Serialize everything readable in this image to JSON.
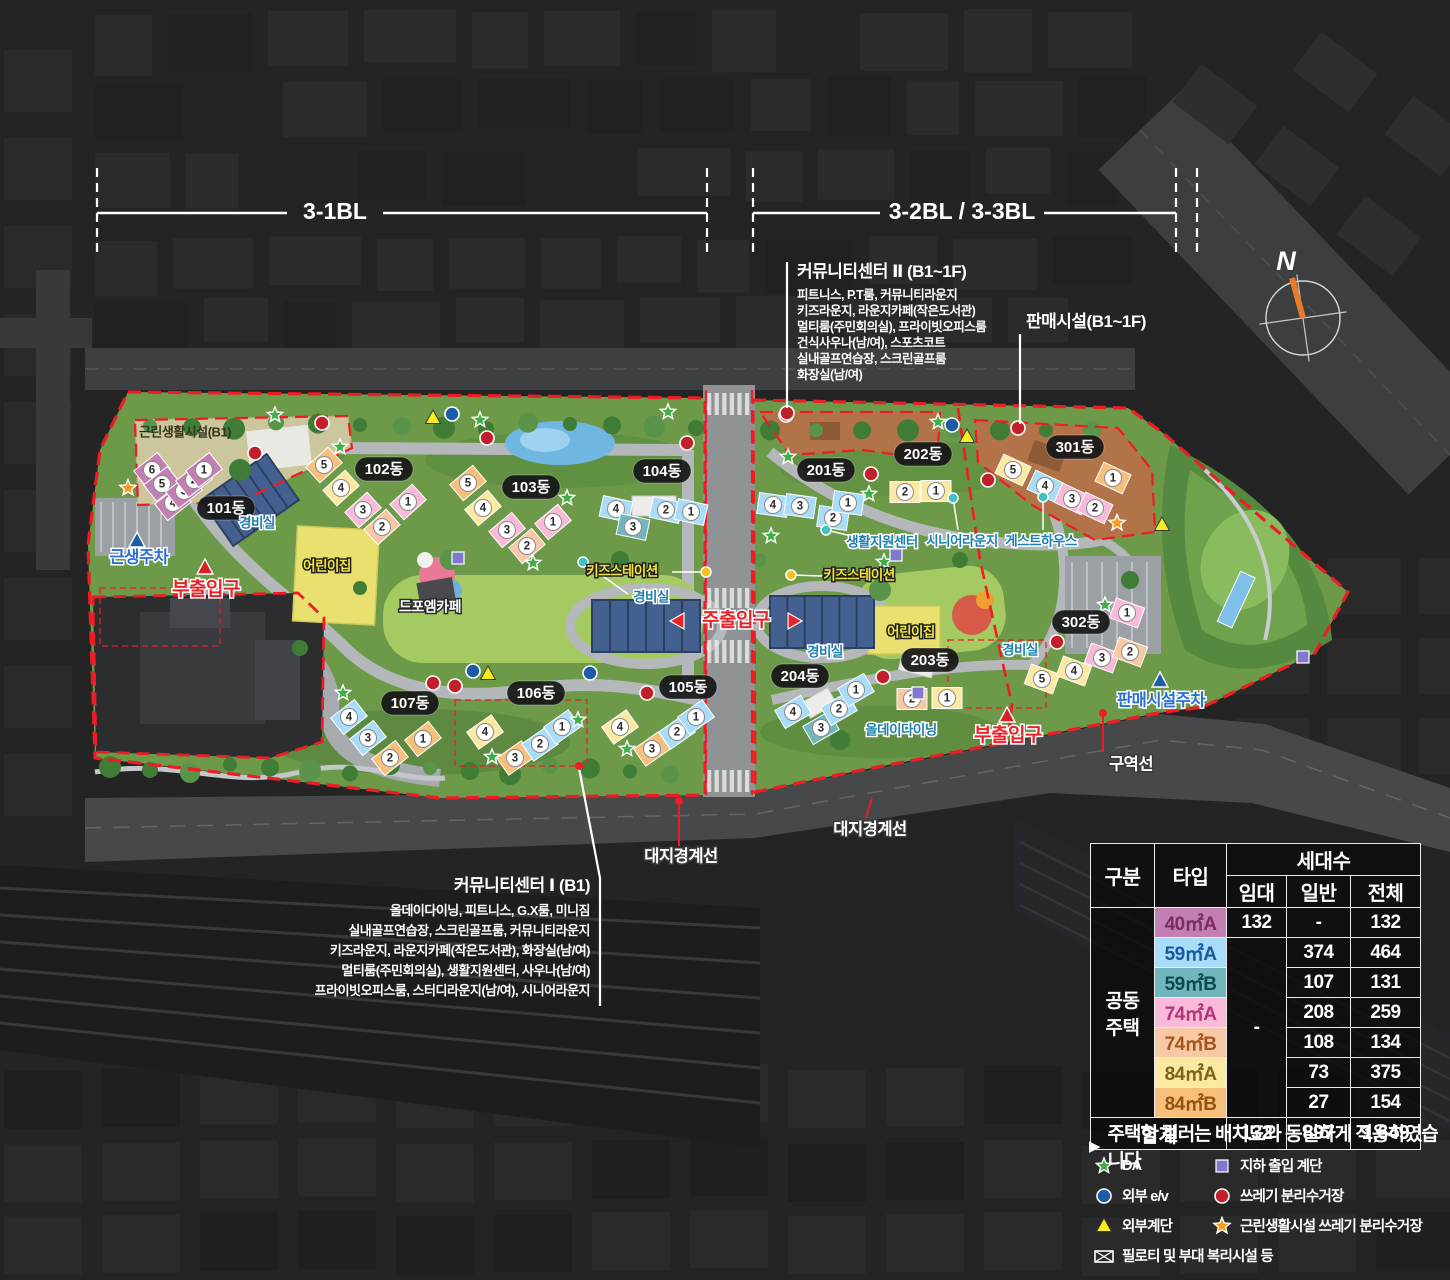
{
  "sections": [
    {
      "label": "3-1BL",
      "x1": 97,
      "x2": 707,
      "label_x": 335,
      "gap": 48,
      "y": 213
    },
    {
      "label": "3-2BL / 3-3BL",
      "x1": 753,
      "x2": 1176,
      "label_x": 962,
      "gap": 82,
      "y": 213,
      "extra_dash_x": 1197
    }
  ],
  "compass": {
    "label": "N"
  },
  "annotations": {
    "community2": {
      "title": "커뮤니티센터 Ⅱ (B1~1F)",
      "lines": [
        "피트니스, P.T룸, 커뮤니티라운지",
        "키즈라운지, 라운지카페(작은도서관)",
        "멀티룸(주민회의실), 프라이빗오피스룸",
        "건식사우나(남/여), 스포츠코트",
        "실내골프연습장, 스크린골프룸",
        "화장실(남/여)"
      ]
    },
    "sales": {
      "title": "판매시설(B1~1F)"
    },
    "community1": {
      "title": "커뮤니티센터 Ⅰ (B1)",
      "lines": [
        "올데이다이닝, 피트니스, G.X룸, 미니짐",
        "실내골프연습장, 스크린골프룸, 커뮤니티라운지",
        "키즈라운지, 라운지카페(작은도서관), 화장실(남/여)",
        "멀티룸(주민회의실), 생활지원센터, 사우나(남/여)",
        "프라이빗오피스룸, 스터디라운지(남/여), 시니어라운지"
      ]
    }
  },
  "table": {
    "col_category": "구분",
    "col_type": "타입",
    "col_units": "세대수",
    "sub_cols": [
      "임대",
      "일반",
      "전체"
    ],
    "group": "공동\n주택",
    "rent_merged": "-",
    "rows": [
      {
        "type": "40㎡A",
        "color": "#c27fb3",
        "text_color": "#7c2a60",
        "rent": "132",
        "general": "-",
        "total": "132"
      },
      {
        "type": "59㎡A",
        "color": "#a9dcf8",
        "text_color": "#15599c",
        "general": "374",
        "total": "464"
      },
      {
        "type": "59㎡B",
        "color": "#72b6bd",
        "text_color": "#0c4950",
        "general": "107",
        "total": "131"
      },
      {
        "type": "74㎡A",
        "color": "#f9bada",
        "text_color": "#b13577",
        "general": "208",
        "total": "259"
      },
      {
        "type": "74㎡B",
        "color": "#f7c8a4",
        "text_color": "#a4561e",
        "general": "108",
        "total": "134"
      },
      {
        "type": "84㎡A",
        "color": "#fbe9a2",
        "text_color": "#7c621a",
        "general": "73",
        "total": "375"
      },
      {
        "type": "84㎡B",
        "color": "#f6c07c",
        "text_color": "#97510f",
        "general": "27",
        "total": "154"
      }
    ],
    "total_row": {
      "label": "합계",
      "rent": "132",
      "general": "897",
      "total": "1,649"
    }
  },
  "note": {
    "marker": "▶",
    "text": "주택형 컬러는 배치도와 동일하게 적용하였습니다"
  },
  "legend": {
    "items": [
      {
        "icon": "star_green",
        "label": "DA"
      },
      {
        "icon": "square_purple",
        "label": "지하 출입 계단"
      },
      {
        "icon": "circle_blue",
        "label": "외부 e/v"
      },
      {
        "icon": "circle_red",
        "label": "쓰레기 분리수거장"
      },
      {
        "icon": "triangle_yellow",
        "label": "외부계단"
      },
      {
        "icon": "star_orange",
        "label": "근린생활시설 쓰레기 분리수거장"
      },
      {
        "icon": "box_x",
        "label": "필로티 및 부대 복리시설 등"
      }
    ]
  },
  "map": {
    "type_colors": {
      "40A": "#c27fb3",
      "59A": "#a9dcf8",
      "59B": "#72b6bd",
      "74A": "#f9bada",
      "74B": "#f7c8a4",
      "84A": "#fbe9a2",
      "84B": "#f6c07c"
    },
    "pills": [
      {
        "text": "101동",
        "x": 226,
        "y": 508
      },
      {
        "text": "102동",
        "x": 384,
        "y": 469
      },
      {
        "text": "103동",
        "x": 531,
        "y": 487
      },
      {
        "text": "104동",
        "x": 662,
        "y": 471
      },
      {
        "text": "105동",
        "x": 688,
        "y": 687
      },
      {
        "text": "106동",
        "x": 536,
        "y": 693
      },
      {
        "text": "107동",
        "x": 410,
        "y": 703
      },
      {
        "text": "201동",
        "x": 826,
        "y": 470
      },
      {
        "text": "202동",
        "x": 923,
        "y": 454
      },
      {
        "text": "203동",
        "x": 930,
        "y": 660
      },
      {
        "text": "204동",
        "x": 800,
        "y": 676
      },
      {
        "text": "301동",
        "x": 1075,
        "y": 447
      },
      {
        "text": "302동",
        "x": 1081,
        "y": 622
      }
    ],
    "buildings": [
      {
        "name": "101동",
        "rot": -38,
        "units": [
          [
            152,
            470,
            6,
            "40A"
          ],
          [
            162,
            484,
            5,
            "40A"
          ],
          [
            173,
            503,
            4,
            "40A"
          ],
          [
            184,
            491,
            3,
            "40A"
          ],
          [
            194,
            480,
            2,
            "40A"
          ],
          [
            204,
            470,
            1,
            "40A"
          ]
        ]
      },
      {
        "name": "102동",
        "rot": -42,
        "units": [
          [
            324,
            465,
            5,
            "84B"
          ],
          [
            341,
            488,
            4,
            "84A"
          ],
          [
            363,
            510,
            3,
            "74A"
          ],
          [
            382,
            527,
            2,
            "74B"
          ],
          [
            408,
            502,
            1,
            "74A"
          ]
        ]
      },
      {
        "name": "103동",
        "rot": -40,
        "units": [
          [
            468,
            483,
            5,
            "84B"
          ],
          [
            483,
            508,
            4,
            "84A"
          ],
          [
            507,
            530,
            3,
            "74A"
          ],
          [
            527,
            546,
            2,
            "74B"
          ],
          [
            553,
            522,
            1,
            "74A"
          ]
        ]
      },
      {
        "name": "104동",
        "rot": 12,
        "units": [
          [
            616,
            509,
            4,
            "59A"
          ],
          [
            633,
            527,
            3,
            "59B"
          ],
          [
            666,
            510,
            2,
            "59A"
          ],
          [
            691,
            512,
            1,
            "59A"
          ]
        ]
      },
      {
        "name": "105동",
        "rot": -35,
        "units": [
          [
            620,
            727,
            4,
            "84A"
          ],
          [
            652,
            749,
            3,
            "84B"
          ],
          [
            677,
            732,
            2,
            "59A"
          ],
          [
            696,
            717,
            1,
            "59A"
          ]
        ]
      },
      {
        "name": "106동",
        "rot": -35,
        "units": [
          [
            485,
            732,
            4,
            "84A"
          ],
          [
            515,
            758,
            3,
            "84B"
          ],
          [
            540,
            744,
            2,
            "59A"
          ],
          [
            562,
            727,
            1,
            "59A"
          ]
        ]
      },
      {
        "name": "107동",
        "rot": -38,
        "units": [
          [
            349,
            717,
            4,
            "59A"
          ],
          [
            368,
            738,
            3,
            "59A"
          ],
          [
            390,
            758,
            2,
            "84B"
          ],
          [
            423,
            739,
            1,
            "84B"
          ]
        ]
      },
      {
        "name": "201동",
        "rot": 8,
        "units": [
          [
            773,
            505,
            4,
            "59A"
          ],
          [
            800,
            506,
            3,
            "59A"
          ],
          [
            833,
            518,
            2,
            "59A"
          ],
          [
            848,
            503,
            1,
            "59A"
          ]
        ]
      },
      {
        "name": "202동",
        "rot": 0,
        "units": [
          [
            905,
            492,
            2,
            "84A"
          ],
          [
            936,
            491,
            1,
            "84A"
          ]
        ]
      },
      {
        "name": "203동",
        "rot": 0,
        "units": [
          [
            912,
            699,
            2,
            "74B"
          ],
          [
            947,
            698,
            1,
            "84A"
          ]
        ]
      },
      {
        "name": "204동",
        "rot": -30,
        "units": [
          [
            793,
            712,
            4,
            "59A"
          ],
          [
            821,
            728,
            3,
            "59B"
          ],
          [
            839,
            709,
            2,
            "59A"
          ],
          [
            856,
            690,
            1,
            "59A"
          ]
        ]
      },
      {
        "name": "301동",
        "rot": 25,
        "units": [
          [
            1013,
            470,
            5,
            "84A"
          ],
          [
            1045,
            486,
            4,
            "59A"
          ],
          [
            1072,
            499,
            3,
            "74A"
          ],
          [
            1095,
            508,
            2,
            "74A"
          ],
          [
            1113,
            478,
            1,
            "84B"
          ]
        ]
      },
      {
        "name": "302동",
        "rot": 20,
        "units": [
          [
            1042,
            679,
            5,
            "84A"
          ],
          [
            1074,
            671,
            4,
            "84A"
          ],
          [
            1102,
            658,
            3,
            "74A"
          ],
          [
            1130,
            652,
            2,
            "74B"
          ],
          [
            1127,
            613,
            1,
            "74A"
          ]
        ]
      }
    ],
    "labels": [
      {
        "text": "근린생활시설(B1)",
        "x": 185,
        "y": 433,
        "style": "dark"
      },
      {
        "text": "근생주차",
        "x": 139,
        "y": 558,
        "style": "blue-big"
      },
      {
        "text": "부출입구",
        "x": 206,
        "y": 590,
        "style": "red-big"
      },
      {
        "text": "주출입구",
        "x": 736,
        "y": 621,
        "style": "red-big",
        "arrows": true
      },
      {
        "text": "부출입구",
        "x": 1008,
        "y": 736,
        "style": "red-big"
      },
      {
        "text": "경비실",
        "x": 257,
        "y": 524,
        "style": "blue"
      },
      {
        "text": "경비실",
        "x": 651,
        "y": 598,
        "style": "blue"
      },
      {
        "text": "경비실",
        "x": 825,
        "y": 653,
        "style": "blue"
      },
      {
        "text": "경비실",
        "x": 1020,
        "y": 651,
        "style": "blue"
      },
      {
        "text": "어린이집",
        "x": 327,
        "y": 567,
        "style": "yellow"
      },
      {
        "text": "어린이집",
        "x": 911,
        "y": 633,
        "style": "yellow"
      },
      {
        "text": "드포엠카페",
        "x": 430,
        "y": 608,
        "style": "white"
      },
      {
        "text": "키즈스테이션",
        "x": 622,
        "y": 572,
        "style": "yellow"
      },
      {
        "text": "키즈스테이션",
        "x": 859,
        "y": 576,
        "style": "yellow"
      },
      {
        "text": "생활지원센터",
        "x": 882,
        "y": 543,
        "style": "teal"
      },
      {
        "text": "시니어라운지",
        "x": 962,
        "y": 542,
        "style": "teal"
      },
      {
        "text": "게스트하우스",
        "x": 1041,
        "y": 542,
        "style": "teal"
      },
      {
        "text": "올데이다이닝",
        "x": 901,
        "y": 731,
        "style": "teal"
      },
      {
        "text": "판매시설주차",
        "x": 1161,
        "y": 701,
        "style": "blue-big"
      },
      {
        "text": "구역선",
        "x": 1131,
        "y": 765,
        "style": "white-plain"
      },
      {
        "text": "대지경계선",
        "x": 681,
        "y": 857,
        "style": "white-plain"
      },
      {
        "text": "대지경계선",
        "x": 870,
        "y": 830,
        "style": "white-plain"
      }
    ],
    "icons": {
      "star_green": [
        [
          275,
          415
        ],
        [
          340,
          447
        ],
        [
          480,
          420
        ],
        [
          567,
          498
        ],
        [
          533,
          563
        ],
        [
          668,
          412
        ],
        [
          938,
          422
        ],
        [
          788,
          457
        ],
        [
          869,
          494
        ],
        [
          771,
          536
        ],
        [
          884,
          562
        ],
        [
          343,
          693
        ],
        [
          492,
          757
        ],
        [
          578,
          720
        ],
        [
          627,
          749
        ],
        [
          1105,
          605
        ]
      ],
      "circle_red": [
        [
          255,
          453
        ],
        [
          322,
          423
        ],
        [
          487,
          438
        ],
        [
          687,
          443
        ],
        [
          786,
          415
        ],
        [
          871,
          474
        ],
        [
          988,
          480
        ],
        [
          883,
          677
        ],
        [
          1057,
          642
        ],
        [
          433,
          683
        ],
        [
          455,
          686
        ],
        [
          647,
          693
        ],
        [
          1018,
          428
        ],
        [
          787,
          413
        ]
      ],
      "circle_blue": [
        [
          452,
          414
        ],
        [
          952,
          425
        ],
        [
          473,
          671
        ],
        [
          590,
          673
        ]
      ],
      "triangle_yellow": [
        [
          433,
          418
        ],
        [
          967,
          437
        ],
        [
          488,
          674
        ],
        [
          1162,
          525
        ]
      ],
      "square_purple": [
        [
          458,
          558
        ],
        [
          896,
          555
        ],
        [
          918,
          693
        ],
        [
          1303,
          657
        ]
      ],
      "star_orange": [
        [
          128,
          488
        ],
        [
          1117,
          523
        ]
      ],
      "triangle_blue": [
        [
          137,
          541
        ],
        [
          1160,
          681
        ]
      ],
      "triangle_red": [
        [
          205,
          568
        ],
        [
          1007,
          716
        ]
      ]
    },
    "dots": [
      [
        583,
        562,
        "#3fc2c2",
        628,
        594
      ],
      [
        826,
        530,
        "#3fc2c2",
        860,
        538
      ],
      [
        953,
        498,
        "#3fc2c2",
        958,
        530
      ],
      [
        1043,
        497,
        "#3fc2c2",
        1043,
        530
      ],
      [
        791,
        575,
        "#f2c21f",
        822,
        576
      ],
      [
        706,
        572,
        "#f2c21f",
        672,
        572
      ]
    ]
  }
}
